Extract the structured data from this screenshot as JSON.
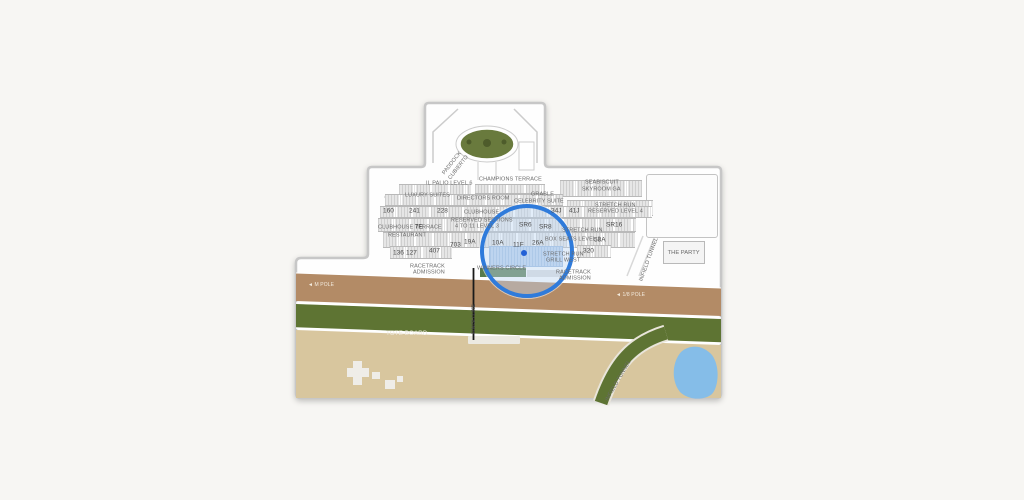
{
  "page": {
    "background": "#f7f6f3"
  },
  "map": {
    "labels": {
      "paddock_line1": "PADDOCK",
      "paddock_line2": "CUBIERTO",
      "il_palio": "IL PALIO LEVEL 6",
      "champions_terrace": "CHAMPIONS TERRACE",
      "seabiscuit_line1": "SEABISCUIT",
      "seabiscuit_line2": "SKYROOM GA",
      "luxury_suites": "LUXURY SUITES",
      "directors_room": "DIRECTORS ROOM",
      "grable_line1": "GRABLE",
      "grable_line2": "CELEBRITY SUITE",
      "stretch_run_l4_line1": "STRETCH RUN",
      "stretch_run_l4_line2": "RESERVED LEVEL 4",
      "clubhouse": "CLUBHOUSE",
      "clubhouse_terrace": "CLUBHOUSE TERRACE",
      "restaurant": "RESTAURANT",
      "reserved_sections_line1": "RESERVED SECTIONS",
      "reserved_sections_line2": "4 TO 11 LEVEL 3",
      "stretch_run_l2_line1": "STRETCH RUN",
      "stretch_run_l2_line2": "BOX SEATS LEVEL 2",
      "stretch_run_grill_line1": "STRETCH RUN",
      "stretch_run_grill_line2": "GRILL WEST",
      "winners_circle": "WINNERS CIRCLE",
      "racetrack_admission_line1": "RACETRACK",
      "racetrack_admission_line2": "ADMISSION",
      "the_party": "THE PARTY",
      "infield_tunnel": "INFIELD TUNNEL",
      "tote_board": "TOTE BOARD",
      "finish_line": "FINISH LINE",
      "pole_left": "◄ M POLE",
      "pole_right": "◄ 1/8 POLE"
    },
    "sections": {
      "s160": "160",
      "s241": "241",
      "s228": "228",
      "s34j": "34J",
      "s41j": "41J",
      "s7e": "7E",
      "sr6": "SR6",
      "sr8": "SR8",
      "sr16": "SR16",
      "s703": "703",
      "s19a": "19A",
      "s10a": "10A",
      "s11f": "11F",
      "s26a": "26A",
      "s58a": "58A",
      "s136": "136",
      "s127": "127",
      "s407": "407",
      "s320": "320"
    },
    "magnifier": {
      "highlighted_sections": [
        "10A",
        "11F",
        "26A"
      ],
      "ring_color": "#2f7bdb",
      "marker_color": "#2361d6"
    },
    "colors": {
      "dirt_track": "#b38b66",
      "turf_track": "#5e7433",
      "infield": "#d8c69e",
      "lake": "#85bde8",
      "paddock_green": "#697a3d",
      "winners_circle_green": "#567a4c"
    }
  }
}
